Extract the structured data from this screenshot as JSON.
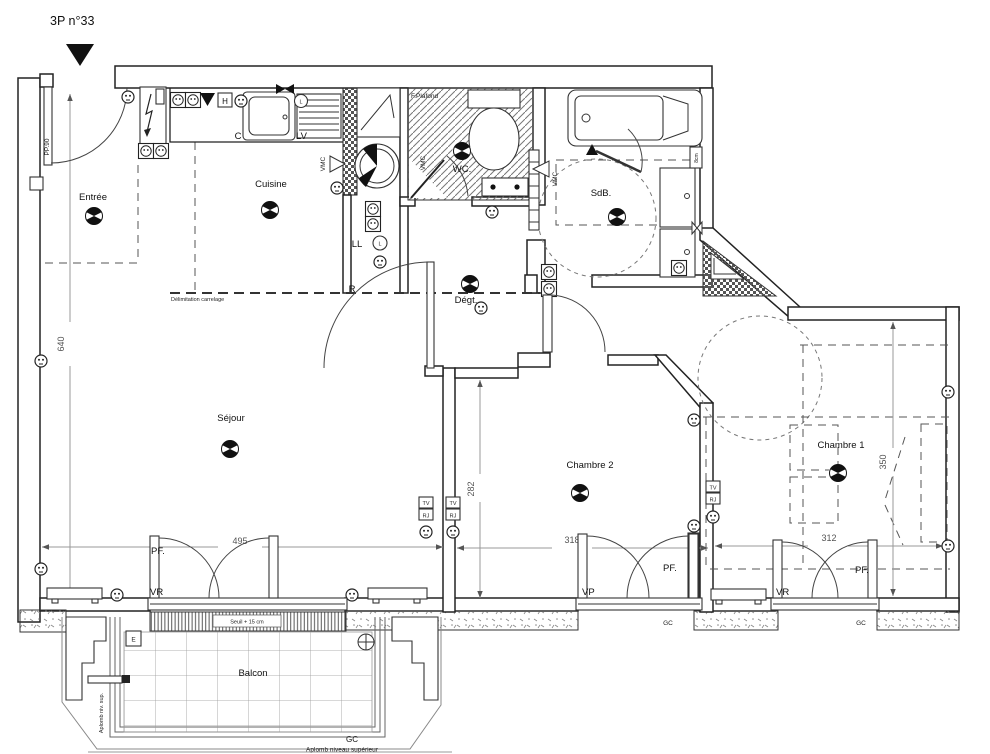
{
  "header": {
    "unit_label": "3P n°33"
  },
  "rooms": {
    "entree": "Entrée",
    "cuisine": "Cuisine",
    "wc": "WC.",
    "sdb": "SdB.",
    "degt": "Dégt.",
    "sejour": "Séjour",
    "chambre2": "Chambre 2",
    "chambre1": "Chambre 1",
    "balcon": "Balcon"
  },
  "dimensions": {
    "entree_height": "640",
    "sejour_width": "495",
    "chambre2_height": "282",
    "chambre2_width": "318",
    "chambre1_width": "312",
    "chambre1_height": "350"
  },
  "annotations": {
    "door_code": "PP.90",
    "delimitation": "Délimitation carrelage",
    "faux_plafond": "F.Plafond",
    "vmc": "VMC",
    "seuil": "Seuil + 15 cm",
    "aplomb_short": "Aplomb niv. sup.",
    "aplomb_long": "Aplomb niveau supérieur",
    "duct": "8cm"
  },
  "equipment": {
    "cooker": "C",
    "dishwasher": "LV",
    "l_point": "L",
    "washer": "LL",
    "fridge": "R",
    "hood": "H",
    "elec": "E",
    "gc": "GC",
    "tv": "TV",
    "rj": "RJ"
  },
  "windows": {
    "pf": "PF.",
    "vr": "VR",
    "vp": "VP"
  }
}
